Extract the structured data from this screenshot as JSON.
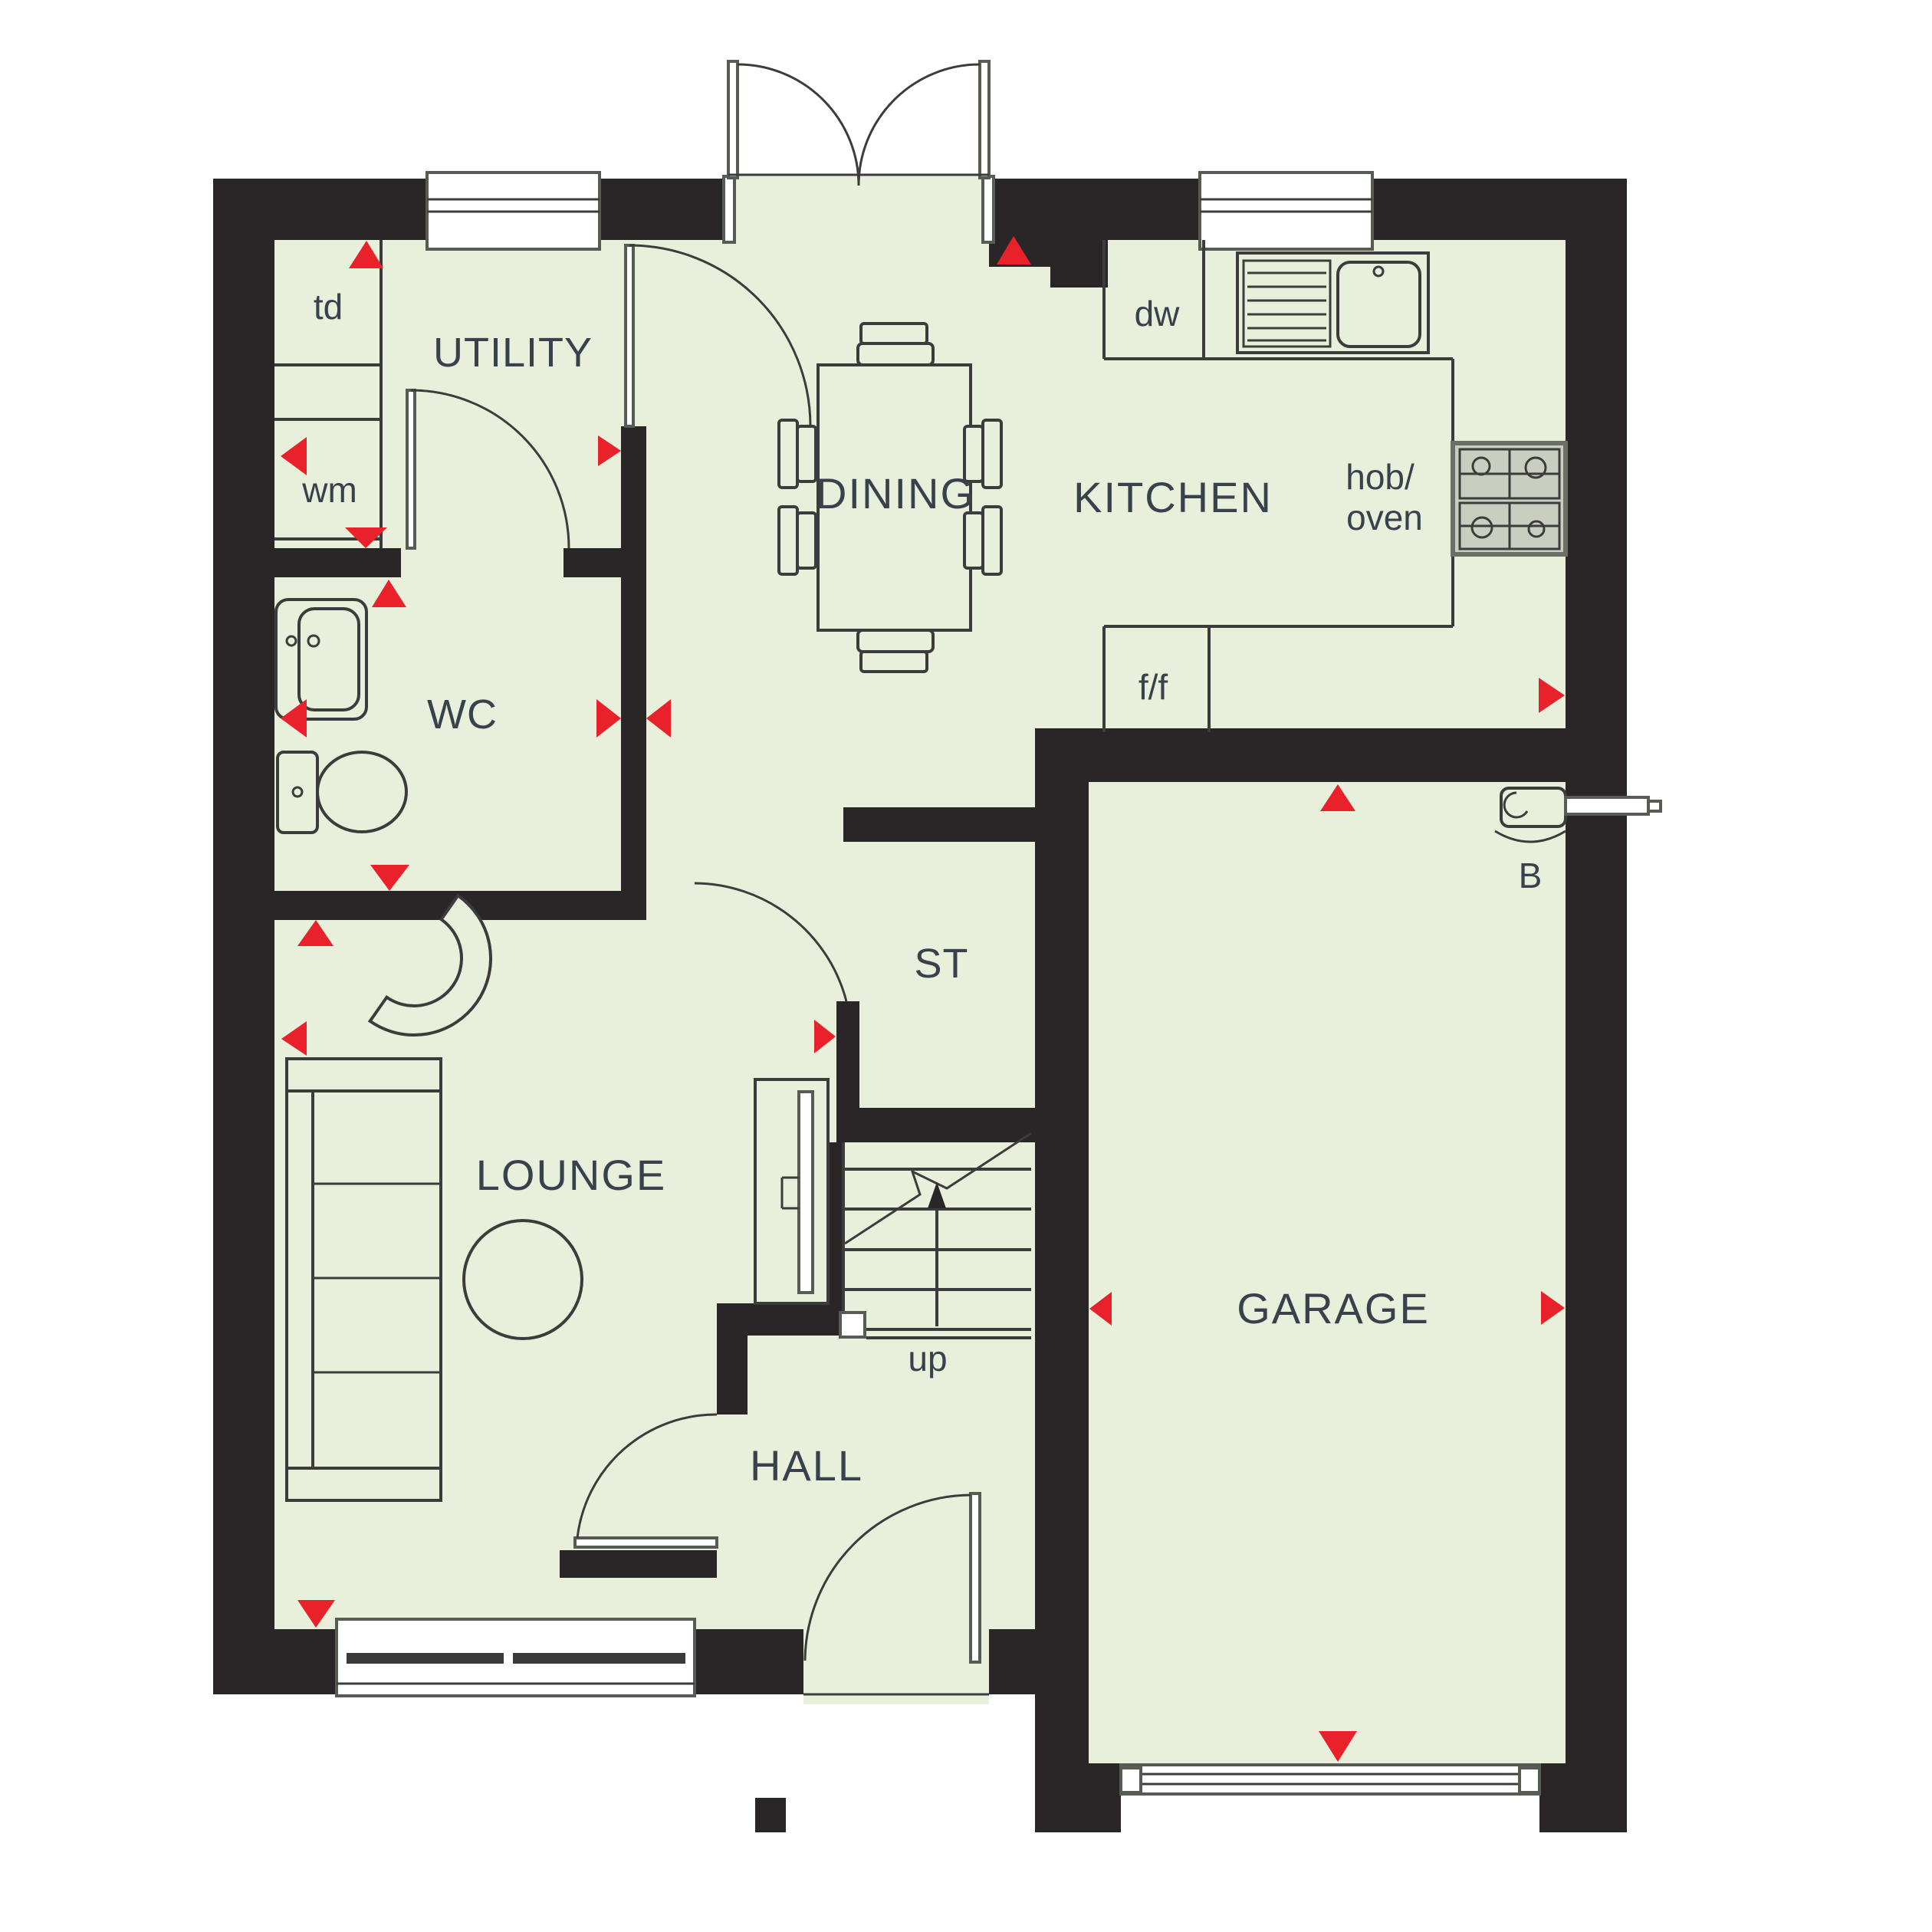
{
  "plan_title": "Ground floor plan",
  "colors": {
    "floor": "#e8efda",
    "wall": "#2a2526",
    "arrow": "#e8212b",
    "label": "#39424c",
    "outline": "#3c3c3c",
    "frame": "#6b6f66",
    "lite": "#8e948a"
  },
  "rooms": {
    "utility": {
      "label": "UTILITY"
    },
    "wc": {
      "label": "WC"
    },
    "dining": {
      "label": "DINING"
    },
    "kitchen": {
      "label": "KITCHEN"
    },
    "store": {
      "label": "ST"
    },
    "lounge": {
      "label": "LOUNGE"
    },
    "hall": {
      "label": "HALL"
    },
    "garage": {
      "label": "GARAGE"
    }
  },
  "annotations": {
    "tumble_dryer": "td",
    "washing_machine": "wm",
    "dishwasher": "dw",
    "fridge_freezer": "f/f",
    "hob_oven_line1": "hob/",
    "hob_oven_line2": "oven",
    "boiler": "B",
    "stairs_direction": "up"
  }
}
